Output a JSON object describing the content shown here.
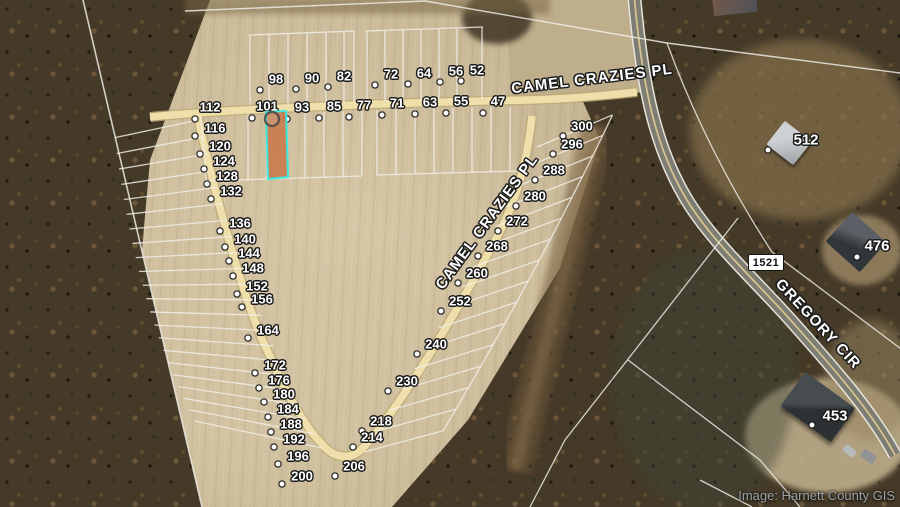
{
  "attribution": "Image: Harnett County GIS",
  "route_shield": "1521",
  "streets": [
    {
      "id": "camel-crazies-pl-top",
      "name": "CAMEL CRAZIES PL",
      "x": 592,
      "y": 79,
      "rot": -7
    },
    {
      "id": "camel-crazies-pl-diagonal",
      "name": "CAMEL CRAZIES PL",
      "x": 487,
      "y": 222,
      "rot": -54
    },
    {
      "id": "gregory-cir",
      "name": "GREGORY CIR",
      "x": 818,
      "y": 324,
      "rot": 47
    }
  ],
  "highlight": {
    "label": "101",
    "fill": "#c8784a",
    "stroke": "#3de8de"
  },
  "lots": {
    "groups": [
      {
        "id": "lots-row-north",
        "dot": [
          -16,
          11
        ],
        "labels": [
          {
            "t": "98",
            "x": 276,
            "y": 79
          },
          {
            "t": "90",
            "x": 312,
            "y": 78
          },
          {
            "t": "82",
            "x": 344,
            "y": 76
          },
          {
            "t": "72",
            "x": 391,
            "y": 74
          },
          {
            "t": "64",
            "x": 424,
            "y": 73
          },
          {
            "t": "56",
            "x": 456,
            "y": 71
          },
          {
            "t": "52",
            "x": 477,
            "y": 70
          }
        ]
      },
      {
        "id": "lots-row-south",
        "dot": [
          -15,
          12
        ],
        "labels": [
          {
            "t": "112",
            "x": 210,
            "y": 107
          },
          {
            "t": "101",
            "x": 267,
            "y": 106
          },
          {
            "t": "93",
            "x": 302,
            "y": 107
          },
          {
            "t": "85",
            "x": 334,
            "y": 106
          },
          {
            "t": "77",
            "x": 364,
            "y": 105
          },
          {
            "t": "71",
            "x": 397,
            "y": 103
          },
          {
            "t": "63",
            "x": 430,
            "y": 102
          },
          {
            "t": "55",
            "x": 461,
            "y": 101
          },
          {
            "t": "47",
            "x": 498,
            "y": 101
          }
        ]
      },
      {
        "id": "lots-west",
        "dot": [
          -20,
          8
        ],
        "labels": [
          {
            "t": "116",
            "x": 215,
            "y": 128
          },
          {
            "t": "120",
            "x": 220,
            "y": 146
          },
          {
            "t": "124",
            "x": 224,
            "y": 161
          },
          {
            "t": "128",
            "x": 227,
            "y": 176
          },
          {
            "t": "132",
            "x": 231,
            "y": 191
          },
          {
            "t": "136",
            "x": 240,
            "y": 223
          },
          {
            "t": "140",
            "x": 245,
            "y": 239
          },
          {
            "t": "144",
            "x": 249,
            "y": 253
          },
          {
            "t": "148",
            "x": 253,
            "y": 268
          },
          {
            "t": "152",
            "x": 257,
            "y": 286
          },
          {
            "t": "156",
            "x": 262,
            "y": 299
          },
          {
            "t": "164",
            "x": 268,
            "y": 330
          },
          {
            "t": "172",
            "x": 275,
            "y": 365
          },
          {
            "t": "176",
            "x": 279,
            "y": 380
          },
          {
            "t": "180",
            "x": 284,
            "y": 394
          },
          {
            "t": "184",
            "x": 288,
            "y": 409
          },
          {
            "t": "188",
            "x": 291,
            "y": 424
          },
          {
            "t": "192",
            "x": 294,
            "y": 439
          },
          {
            "t": "196",
            "x": 298,
            "y": 456
          },
          {
            "t": "200",
            "x": 302,
            "y": 476
          }
        ]
      },
      {
        "id": "lots-east",
        "dot": [
          -19,
          10
        ],
        "labels": [
          {
            "t": "300",
            "x": 582,
            "y": 126
          },
          {
            "t": "296",
            "x": 572,
            "y": 144
          },
          {
            "t": "288",
            "x": 554,
            "y": 170
          },
          {
            "t": "280",
            "x": 535,
            "y": 196
          },
          {
            "t": "272",
            "x": 517,
            "y": 221
          },
          {
            "t": "268",
            "x": 497,
            "y": 246
          },
          {
            "t": "260",
            "x": 477,
            "y": 273
          },
          {
            "t": "252",
            "x": 460,
            "y": 301
          },
          {
            "t": "240",
            "x": 436,
            "y": 344
          },
          {
            "t": "230",
            "x": 407,
            "y": 381
          },
          {
            "t": "218",
            "x": 381,
            "y": 421
          },
          {
            "t": "214",
            "x": 372,
            "y": 437
          },
          {
            "t": "206",
            "x": 354,
            "y": 466
          }
        ]
      }
    ]
  },
  "houses": [
    {
      "t": "512",
      "x": 806,
      "y": 140,
      "dot_x": 768,
      "dot_y": 150
    },
    {
      "t": "476",
      "x": 877,
      "y": 246,
      "dot_x": 857,
      "dot_y": 257
    },
    {
      "t": "453",
      "x": 835,
      "y": 416,
      "dot_x": 812,
      "dot_y": 425
    }
  ]
}
